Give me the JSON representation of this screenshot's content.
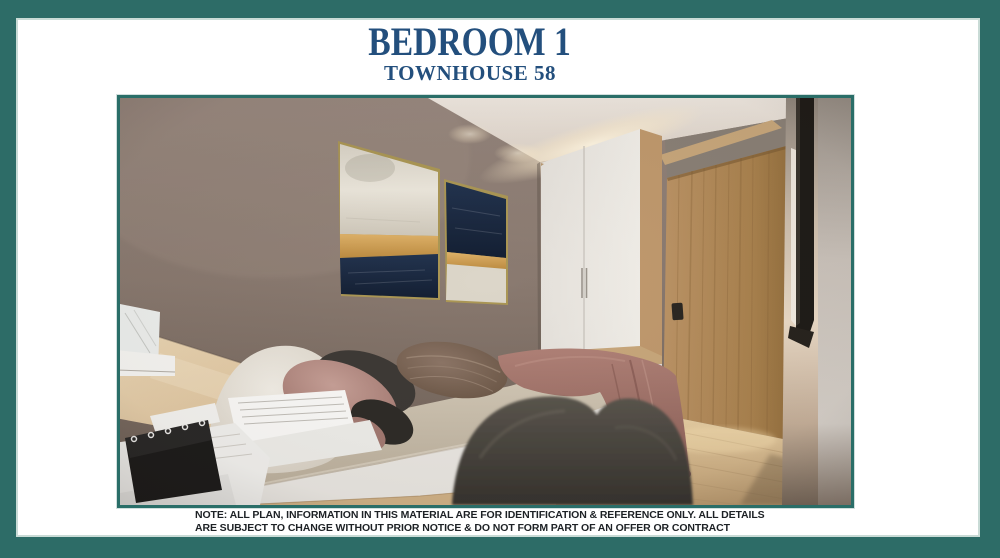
{
  "header": {
    "title": "BEDROOM 1",
    "subtitle": "TOWNHOUSE 58"
  },
  "image": {
    "alt": "3D interior render of a compact bedroom: taupe feature wall with two navy, gold and white abstract paintings, white two-door wardrobe with light oak trim, oak entry door, platform bed with white, blush, charcoal and brown pillows, mauve throw blanket draped over the bed foot, dark upholstered chair in the foreground and a light wood desk with papers and a black flip calendar"
  },
  "note": {
    "line1": "NOTE: ALL PLAN, INFORMATION IN THIS MATERIAL ARE FOR IDENTIFICATION & REFERENCE ONLY. ALL DETAILS",
    "line2": "ARE SUBJECT TO CHANGE WITHOUT PRIOR NOTICE & DO NOT FORM PART OF AN OFFER OR CONTRACT"
  },
  "colors": {
    "frame_teal": "#2d6c67",
    "image_border_teal": "#2a6e68",
    "title_blue": "#234f7d",
    "note_text": "#1d2125"
  }
}
